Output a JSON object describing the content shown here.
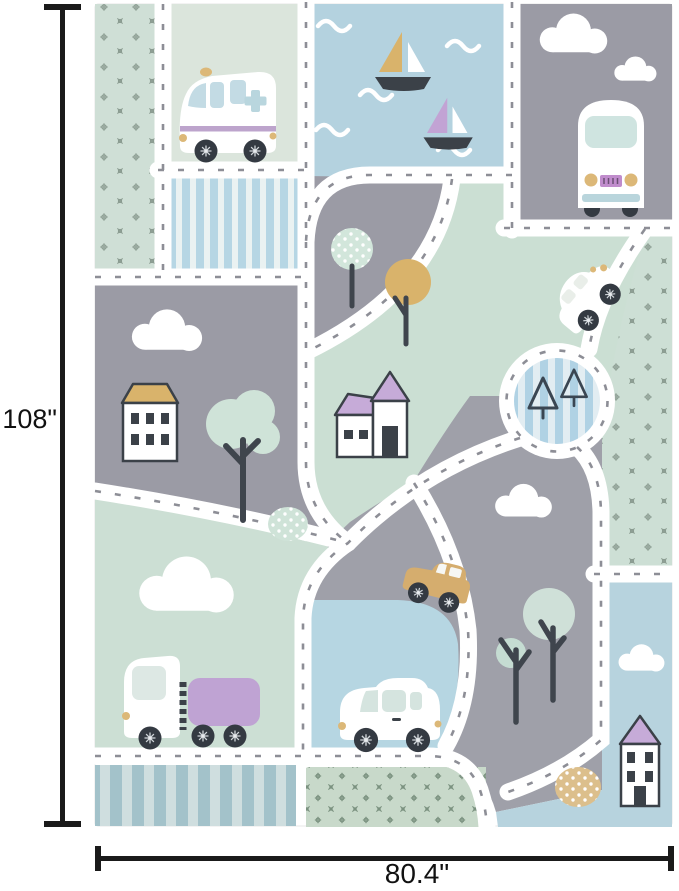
{
  "dimensions": {
    "height_label": "108\"",
    "width_label": "80.4\"",
    "line_color": "#1a1a1a"
  },
  "rug": {
    "palette": {
      "road_white": "#ffffff",
      "gray_patch": "#9b9ba5",
      "gray_patch_light": "#9fa0a9",
      "mint_green": "#cbdfd3",
      "sage": "#dbe5dc",
      "water_blue": "#b4d2df",
      "pond_blue": "#b6d6e2",
      "corner_blue": "#b7d3de",
      "stripe_blue": "#b6d6e4",
      "stripe_steel": "#a3c2ca",
      "dotted_green": "#c8d9ca",
      "purple": "#c6abd8",
      "purple_stripe": "#bda4cc",
      "gold": "#d9b36b",
      "gold_light": "#dcb878",
      "dark_outline": "#3b4148",
      "dash_gray": "#8d8e96"
    },
    "elements": [
      "dotted-patch-top-left",
      "ambulance-van",
      "striped-patch-blue",
      "water-with-waves",
      "sailboat-gold",
      "sailboat-purple",
      "gray-patch-with-bus",
      "camper-bus",
      "clouds",
      "mint-dotted-tree",
      "gold-tree",
      "white-car-on-road",
      "roundabout-with-pine-trees",
      "church-with-purple-roof",
      "green-dotted-patch-right",
      "house-with-gold-roof",
      "mint-tree",
      "dotted-bush",
      "gold-car",
      "truck-with-purple-trailer",
      "striped-patch-bottom",
      "white-hatchback-car",
      "green-dotted-patch-bottom",
      "bare-trees",
      "purple-roof-house",
      "gold-dotted-bush",
      "road-network"
    ]
  }
}
